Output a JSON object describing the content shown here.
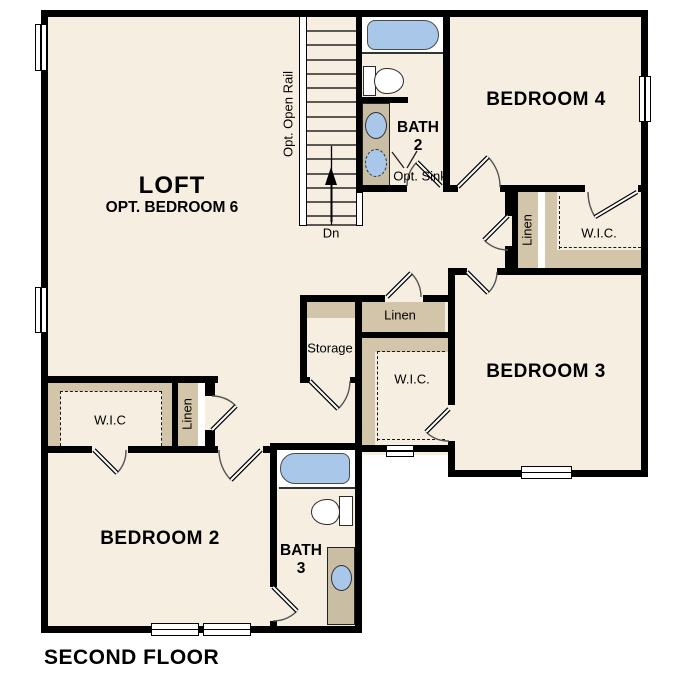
{
  "plan_title": "SECOND FLOOR",
  "rooms": {
    "loft": {
      "label": "LOFT",
      "sublabel": "OPT. BEDROOM 6"
    },
    "bedroom_4": {
      "label": "BEDROOM 4"
    },
    "bedroom_3": {
      "label": "BEDROOM 3"
    },
    "bedroom_2": {
      "label": "BEDROOM 2"
    },
    "bath_2": {
      "label": "BATH",
      "number": "2",
      "note": "Opt. Sink"
    },
    "bath_3": {
      "label": "BATH",
      "number": "3"
    }
  },
  "closets": {
    "wic_bedroom4": {
      "label": "W.I.C."
    },
    "wic_bedroom3": {
      "label": "W.I.C."
    },
    "wic_bedroom2": {
      "label": "W.I.C"
    },
    "linen_upper_hall": {
      "label": "Linen"
    },
    "linen_center_hall": {
      "label": "Linen"
    },
    "linen_bedroom2": {
      "label": "Linen"
    },
    "storage": {
      "label": "Storage"
    }
  },
  "stairs": {
    "rail_note": "Opt. Open Rail",
    "direction_label": "Dn"
  },
  "colors": {
    "wall": "#000000",
    "floor": "#f6eee1",
    "closet_shelf": "#d2c5aa",
    "vanity": "#c9bda3",
    "fixture_blue": "#a9c7e9",
    "background": "#ffffff"
  }
}
